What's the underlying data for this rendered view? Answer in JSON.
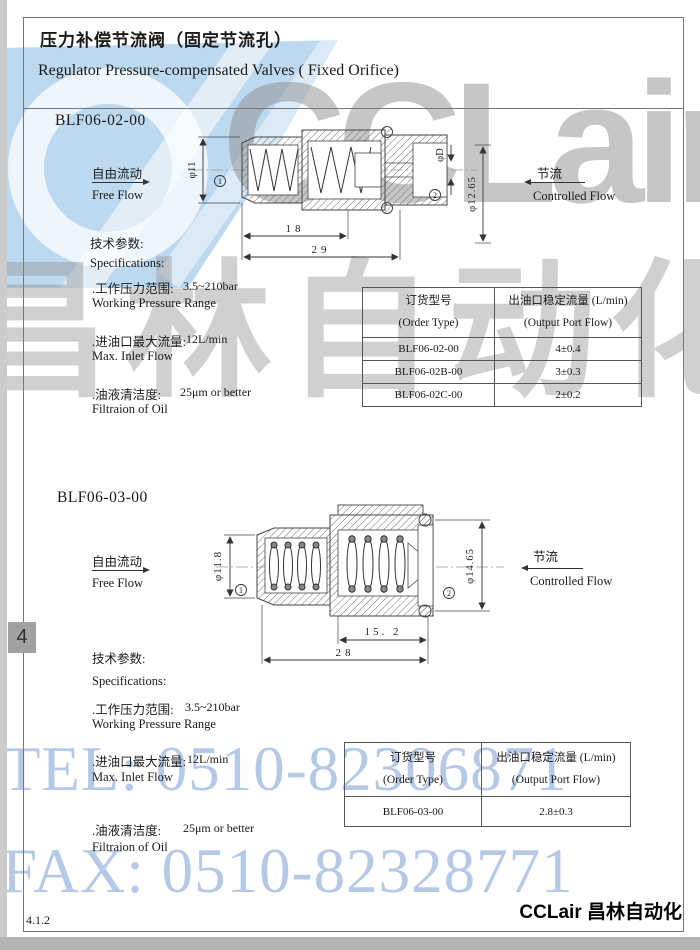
{
  "document": {
    "title_cn": "压力补偿节流阀（固定节流孔）",
    "title_en": "Regulator Pressure-compensated Valves ( Fixed Orifice)",
    "page_tab": "4",
    "footer_code": "4.1.2",
    "brand_footer": "CCLair 昌林自动化"
  },
  "watermarks": {
    "logo": "CCLair",
    "brand_cn": "昌林自动化",
    "tel": "TEL: 0510-82306871",
    "fax": "FAX: 0510-82328771"
  },
  "colors": {
    "swoosh_blue": "#bdd9f0",
    "watermark_gray": "#8f8f8f",
    "watermark_blue_text": "#a9c0e2",
    "line_dark": "#333333"
  },
  "labels": {
    "free_flow_cn": "自由流动",
    "free_flow_en": "Free Flow",
    "controlled_flow_cn": "节流",
    "controlled_flow_en": "Controlled Flow",
    "specs_cn": "技术参数:",
    "specs_en": "Specifications:"
  },
  "sections": [
    {
      "model": "BLF06-02-00",
      "specs": [
        {
          "cn": ".工作压力范围:",
          "en": "Working Pressure Range",
          "value": "3.5~210bar"
        },
        {
          "cn": ".进油口最大流量:",
          "en": "Max. Inlet Flow",
          "value": "12L/min"
        },
        {
          "cn": ".油液清洁度:",
          "en": "Filtraion of Oil",
          "value": "25μm or better"
        }
      ],
      "drawing": {
        "dia_left": "φ11",
        "dia_orifice": "φD",
        "dia_right": "φ12.65",
        "len_inner": "18",
        "len_outer": "29",
        "port1": "1",
        "port2": "2"
      },
      "table": {
        "header": {
          "col1_cn": "订货型号",
          "col1_en": "(Order Type)",
          "col2_cn": "出油口稳定流量 (L/min)",
          "col2_en": "(Output Port Flow)"
        },
        "rows": [
          {
            "order_type": "BLF06-02-00",
            "flow": "4±0.4"
          },
          {
            "order_type": "BLF06-02B-00",
            "flow": "3±0.3"
          },
          {
            "order_type": "BLF06-02C-00",
            "flow": "2±0.2"
          }
        ]
      }
    },
    {
      "model": "BLF06-03-00",
      "specs": [
        {
          "cn": ".工作压力范围:",
          "en": "Working Pressure Range",
          "value": "3.5~210bar"
        },
        {
          "cn": ".进油口最大流量:",
          "en": "Max. Inlet Flow",
          "value": "12L/min"
        },
        {
          "cn": ".油液清洁度:",
          "en": "Filtraion of Oil",
          "value": "25μm or better"
        }
      ],
      "drawing": {
        "dia_left": "φ11.8",
        "dia_right": "φ14.65",
        "len_inner": "15. 2",
        "len_outer": "28",
        "port1": "1",
        "port2": "2"
      },
      "table": {
        "header": {
          "col1_cn": "订货型号",
          "col1_en": "(Order Type)",
          "col2_cn": "出油口稳定流量 (L/min)",
          "col2_en": "(Output Port Flow)"
        },
        "rows": [
          {
            "order_type": "BLF06-03-00",
            "flow": "2.8±0.3"
          }
        ]
      }
    }
  ]
}
